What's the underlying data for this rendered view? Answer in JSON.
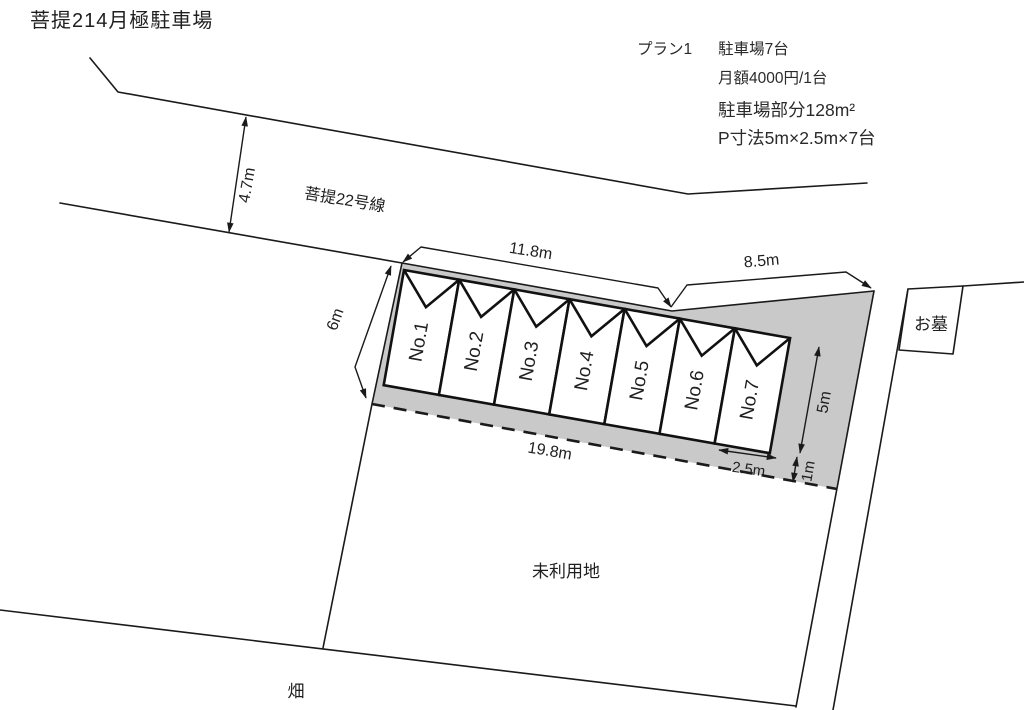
{
  "title": "菩提214月極駐車場",
  "plan_info": {
    "plan_label": "プラン1",
    "capacity": "駐車場7台",
    "monthly_fee": "月額4000円/1台",
    "parking_area": "駐車場部分128m²",
    "stall_size": "P寸法5m×2.5m×7台"
  },
  "road": {
    "name": "菩提22号線",
    "width": "4.7m"
  },
  "dimensions": {
    "front_left": "11.8m",
    "front_right": "8.5m",
    "left_side": "6m",
    "bottom": "19.8m",
    "stall_depth": "5m",
    "rear_margin": "1m",
    "stall_width": "2.5m"
  },
  "stalls": [
    "No.1",
    "No.2",
    "No.3",
    "No.4",
    "No.5",
    "No.6",
    "No.7"
  ],
  "areas": {
    "grave": "お墓",
    "unused_land": "未利用地",
    "field": "畑"
  },
  "colors": {
    "line": "#1a1a1a",
    "parking_area_fill": "#c9c9c9",
    "background": "#ffffff"
  }
}
